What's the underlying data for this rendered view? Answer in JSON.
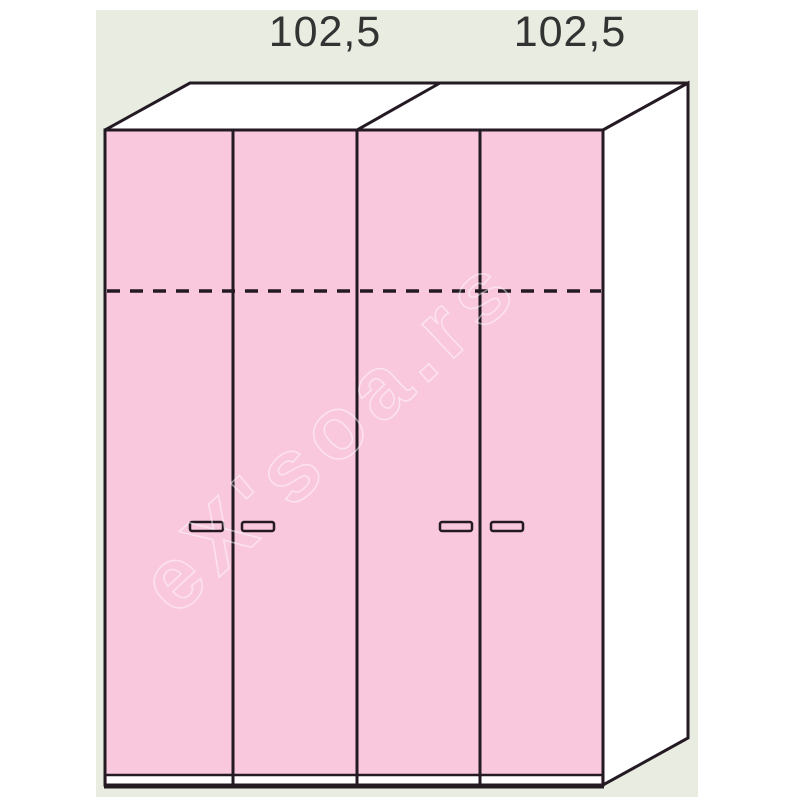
{
  "colors": {
    "page-bg": "#ffffff",
    "diagram-bg": "#e9ede1",
    "door-pink": "#f9c8dc",
    "line-dark": "#241a24",
    "panel-white": "#ffffff",
    "label-color": "#333333"
  },
  "diagram": {
    "kind": "wardrobe front/perspective technical drawing",
    "dimension_labels": [
      "102,5",
      "102,5"
    ],
    "watermark_text": "eX'soa.rs",
    "wardrobe": {
      "units": 2,
      "doors_total": 4,
      "handles_total": 4,
      "has_dashed_shelf_line": true
    }
  }
}
